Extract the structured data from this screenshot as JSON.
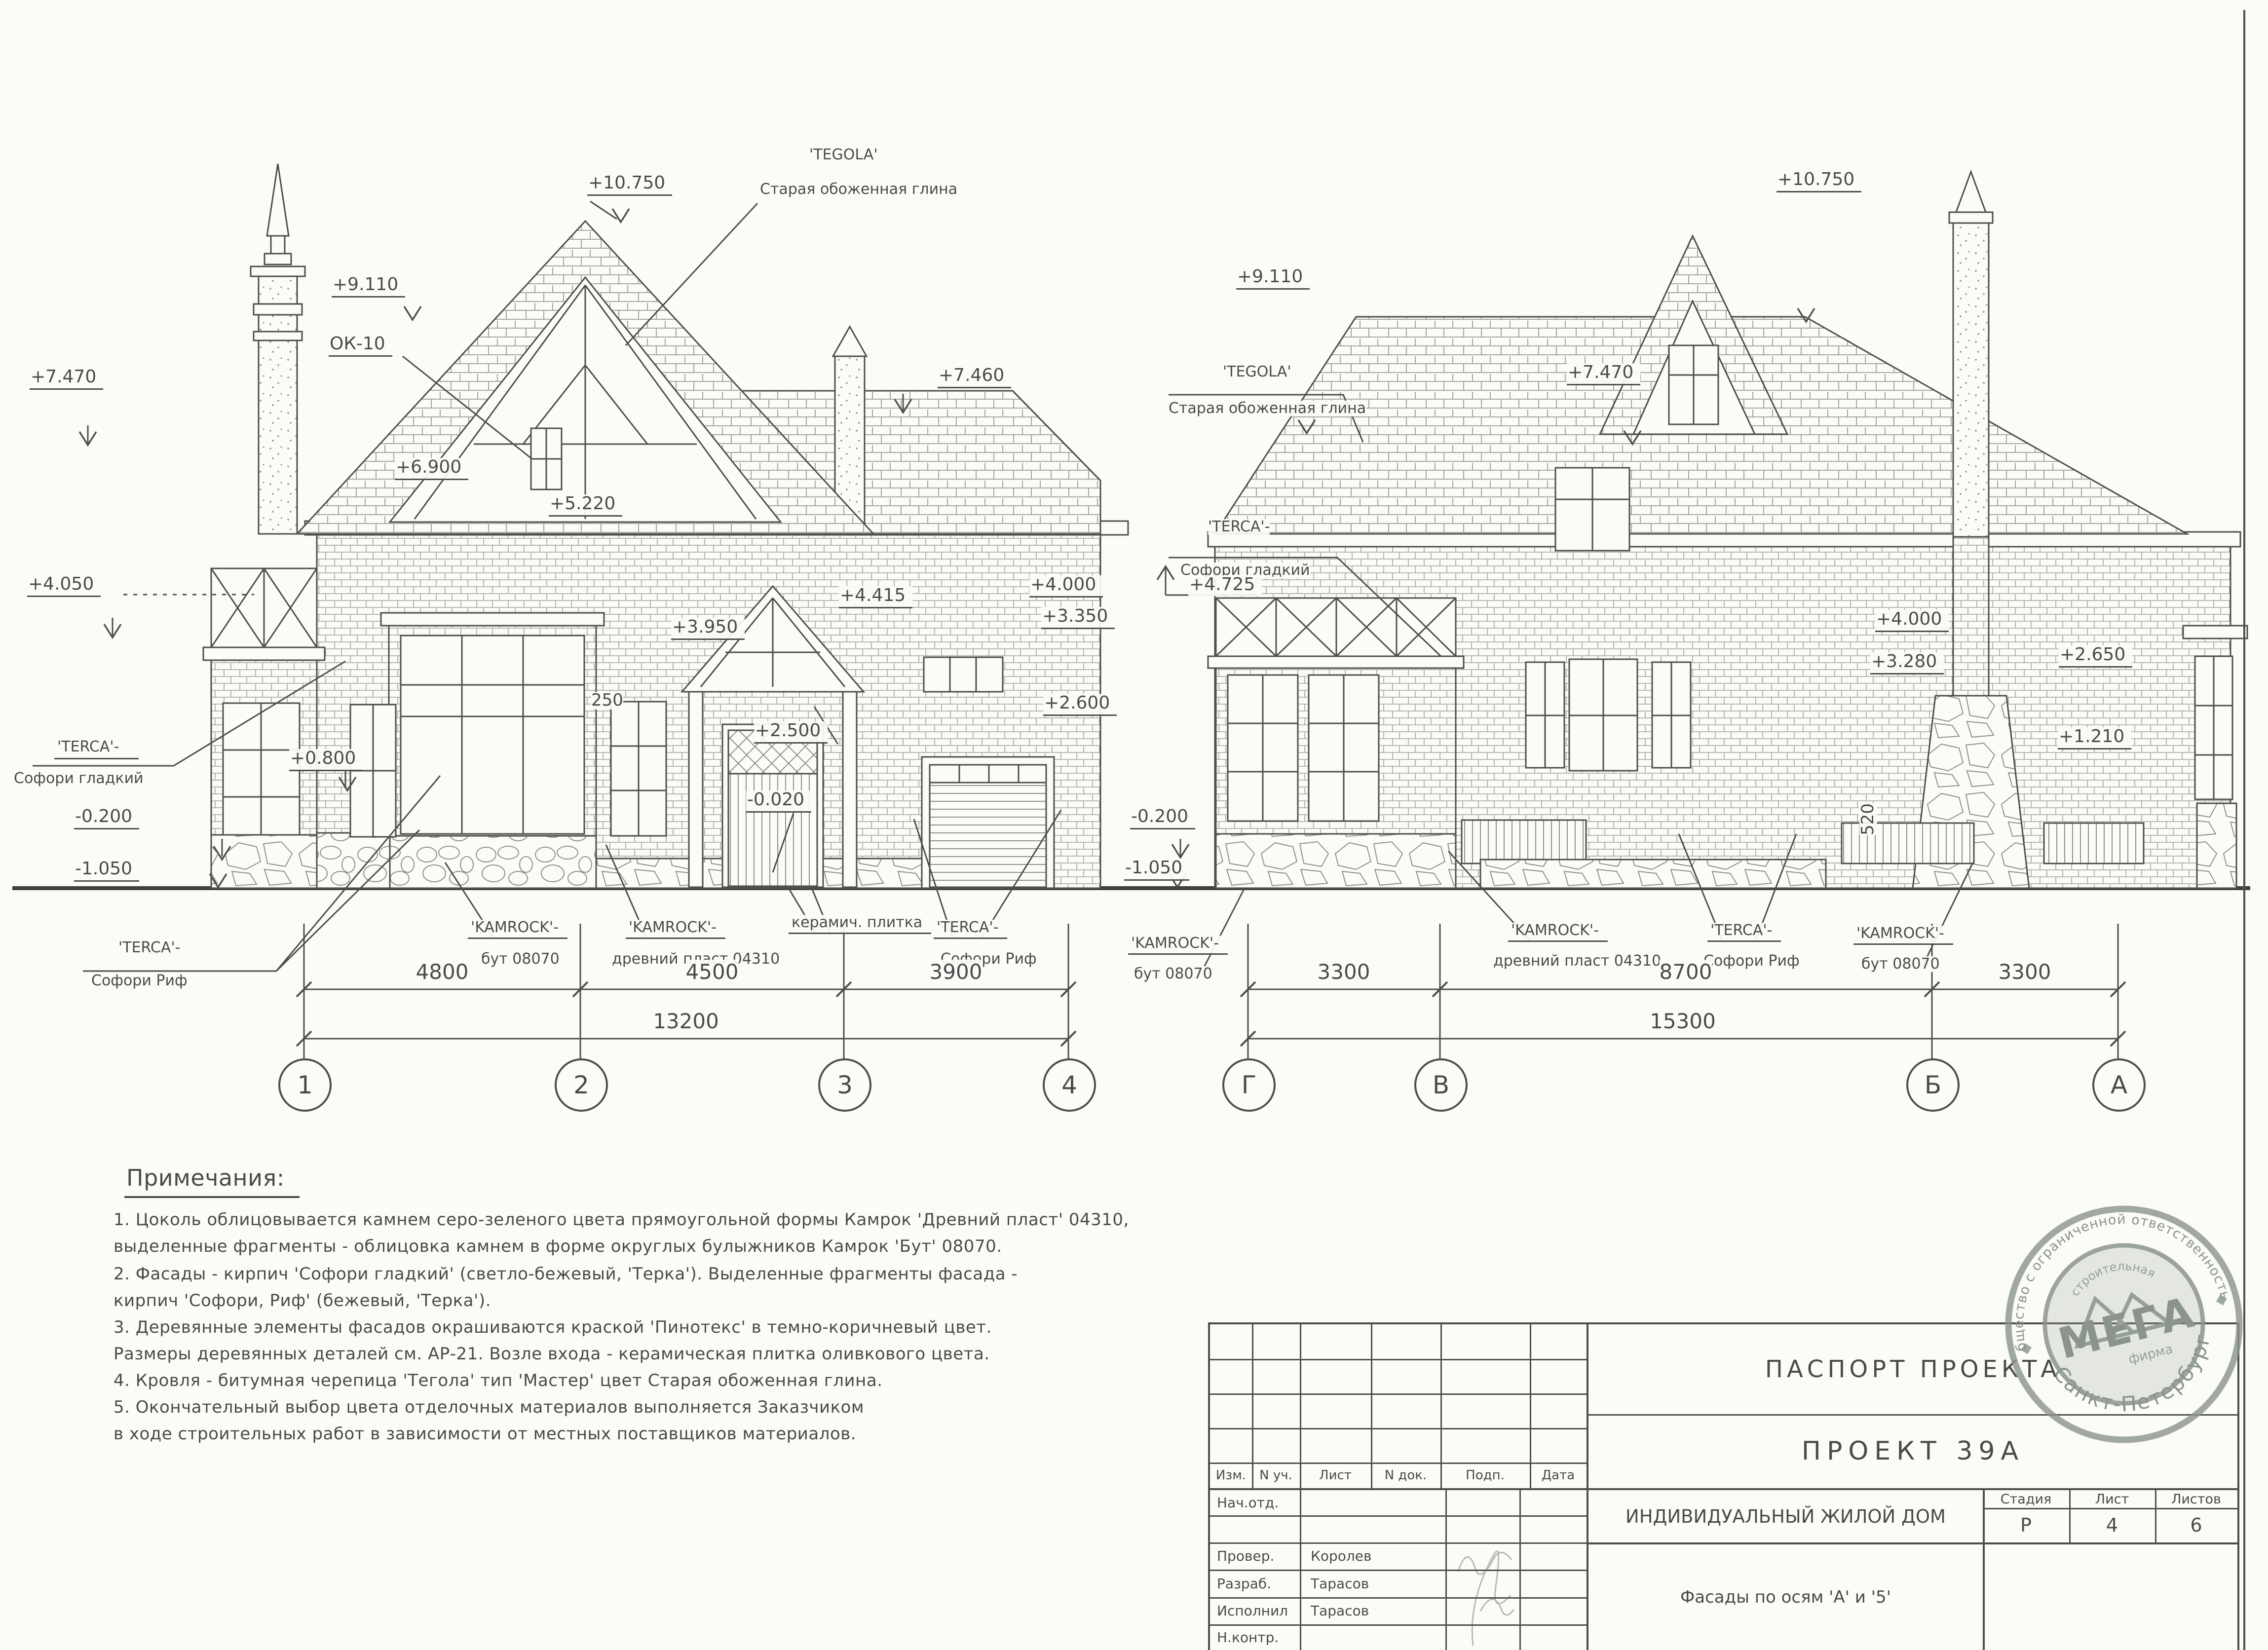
{
  "left": {
    "marks": {
      "m7470": "+7.470",
      "m4050": "+4.050",
      "m9110": "+9.110",
      "ok10": "ОК-10",
      "m10750": "+10.750",
      "m6900": "+6.900",
      "m5220": "+5.220",
      "m3950": "+3.950",
      "d250": "250",
      "m0800": "+0.800",
      "m2500": "+2.500",
      "m0020": "-0.020",
      "m7460": "+7.460",
      "m4415": "+4.415",
      "m4000": "+4.000",
      "m3350": "+3.350",
      "m2600": "+2.600",
      "mneg0200": "-0.200",
      "mneg1050": "-1.050"
    },
    "callouts": {
      "tegola1": "'TEGOLA'",
      "tegola2": "Старая обоженная глина",
      "terca_smooth1": "'TERCA'-",
      "terca_smooth2": "Софори гладкий",
      "terca_rif_a1": "'TERCA'-",
      "terca_rif_a2": "Софори Риф",
      "kamrock_but1": "'KAMROCK'-",
      "kamrock_but2": "бут 08070",
      "kamrock_pl1": "'KAMROCK'-",
      "kamrock_pl2": "древний пласт 04310",
      "keram": "керамич. плитка",
      "terca_rif_b1": "'TERCA'-",
      "terca_rif_b2": "Софори Риф"
    },
    "dims": {
      "d1": "4800",
      "d2": "4500",
      "d3": "3900",
      "total": "13200"
    },
    "axes": [
      "1",
      "2",
      "3",
      "4"
    ]
  },
  "right": {
    "marks": {
      "m9110": "+9.110",
      "m10750": "+10.750",
      "m7470": "+7.470",
      "m4725": "+4.725",
      "m4000": "+4.000",
      "m3280": "+3.280",
      "m2650": "+2.650",
      "m1210": "+1.210",
      "d520": "520",
      "mneg0200": "-0.200",
      "mneg1050": "-1.050"
    },
    "callouts": {
      "tegola1": "'TEGOLA'",
      "tegola2": "Старая обоженная глина",
      "terca_smooth1": "'TERCA'-",
      "terca_smooth2": "Софори гладкий",
      "kamrock_but_l1": "'KAMROCK'-",
      "kamrock_but_l2": "бут 08070",
      "kamrock_pl1": "'KAMROCK'-",
      "kamrock_pl2": "древний пласт 04310",
      "terca_rif1": "'TERCA'-",
      "terca_rif2": "Софори Риф",
      "kamrock_but_r1": "'KAMROCK'-",
      "kamrock_but_r2": "бут 08070"
    },
    "dims": {
      "d1": "3300",
      "d2": "8700",
      "d3": "3300",
      "total": "15300"
    },
    "axes": [
      "Г",
      "В",
      "Б",
      "А"
    ]
  },
  "notes": {
    "title": "Примечания:",
    "lines": [
      "1. Цоколь облицовывается камнем серо-зеленого цвета прямоугольной формы Камрок 'Древний пласт' 04310,",
      "выделенные фрагменты - облицовка камнем в форме округлых булыжников Камрок 'Бут' 08070.",
      "2. Фасады - кирпич 'Софори гладкий' (светло-бежевый, 'Терка'). Выделенные фрагменты фасада -",
      "кирпич 'Софори, Риф' (бежевый, 'Терка').",
      "3. Деревянные элементы фасадов окрашиваются краской 'Пинотекс' в темно-коричневый цвет.",
      "Размеры деревянных деталей см. АР-21. Возле входа - керамическая плитка оливкового цвета.",
      "4. Кровля - битумная черепица 'Тегола' тип 'Мастер' цвет Старая обоженная глина.",
      "5. Окончательный выбор цвета отделочных материалов выполняется Заказчиком",
      "в ходе строительных работ в зависимости от местных поставщиков материалов."
    ]
  },
  "tb": {
    "passport": "ПАСПОРТ ПРОЕКТА",
    "project": "ПРОЕКТ  39А",
    "object": "ИНДИВИДУАЛЬНЫЙ ЖИЛОЙ ДОМ",
    "sheet_title": "Фасады по осям 'А' и '5'",
    "h_izm": "Изм.",
    "h_nuch": "N уч.",
    "h_list": "Лист",
    "h_ndok": "N док.",
    "h_podp": "Подп.",
    "h_data": "Дата",
    "r1": "Нач.отд.",
    "r2": "",
    "r3": "Провер.",
    "r3n": "Королев",
    "r4": "Разраб.",
    "r4n": "Тарасов",
    "r5": "Исполнил",
    "r5n": "Тарасов",
    "r6": "Н.контр.",
    "stage_label": "Стадия",
    "sheet_label": "Лист",
    "sheets_label": "Листов",
    "stage": "Р",
    "sheet_num": "4",
    "sheets_total": "6"
  },
  "stamp": {
    "ring_top": "Общество с ограниченной ответственностью",
    "ring_bottom": "Санкт-Петербург",
    "name": "МЕГА",
    "sub1": "строительная",
    "sub2": "фирма"
  },
  "ink": "#4e4e4e",
  "stamp_color": "#8b948c"
}
